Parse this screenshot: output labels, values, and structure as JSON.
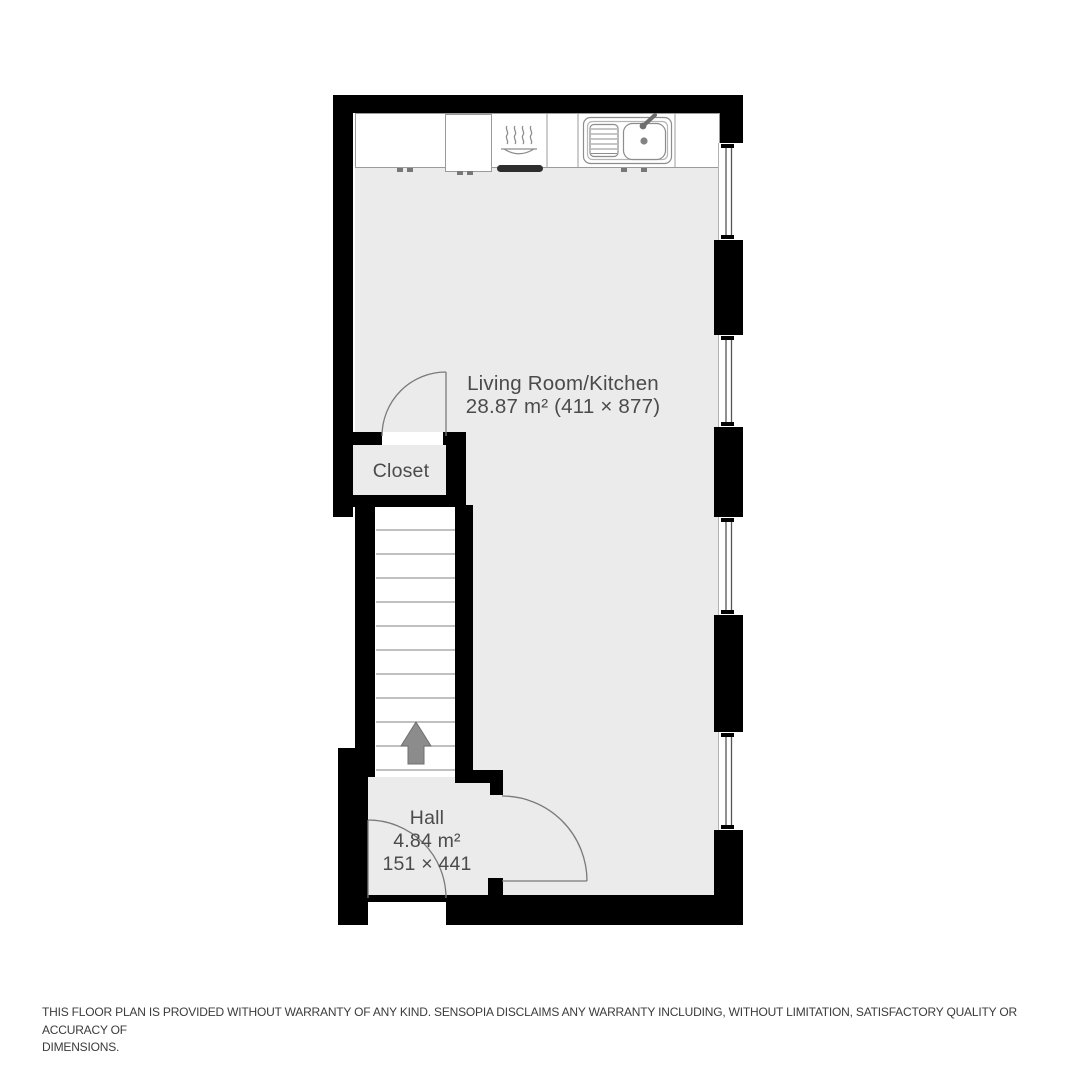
{
  "plan": {
    "rooms": {
      "living_kitchen": {
        "name": "Living Room/Kitchen",
        "dims": "28.87 m² (411 × 877)"
      },
      "closet": {
        "name": "Closet"
      },
      "hall": {
        "name": "Hall",
        "area": "4.84 m²",
        "dims": "151 × 441"
      }
    },
    "stairs": {
      "steps": 11,
      "direction": "up"
    },
    "windows_count": 4,
    "doors_count": 3,
    "fixtures": [
      "kitchen-counter",
      "stove",
      "oven",
      "double-sink",
      "faucet"
    ]
  },
  "colors": {
    "wall": "#000000",
    "floor": "#ebebeb",
    "counter_line": "#9b9b9b",
    "fixture_line": "#8d8d8d",
    "door_line": "#7a7a7a",
    "step_line": "#9a9a9a",
    "arrow": "#8c8c8c",
    "label_text": "#4b4b4b",
    "oven_bar": "#2e2e2e",
    "glass_line": "#555555"
  },
  "disclaimer": {
    "line1": "THIS FLOOR PLAN IS PROVIDED WITHOUT WARRANTY OF ANY KIND. SENSOPIA DISCLAIMS ANY WARRANTY INCLUDING, WITHOUT LIMITATION, SATISFACTORY QUALITY OR ACCURACY OF",
    "line2": "DIMENSIONS."
  }
}
